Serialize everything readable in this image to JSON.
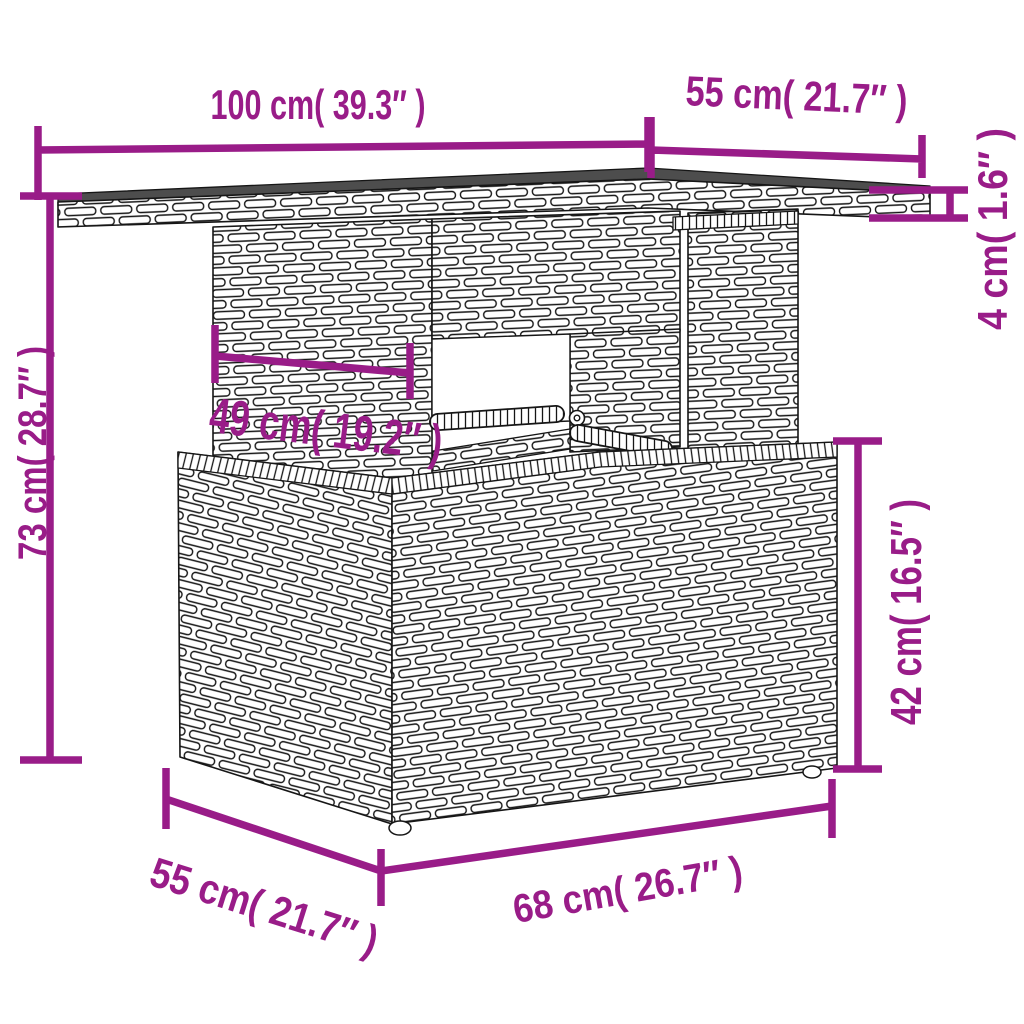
{
  "diagram": {
    "type": "product-dimension-diagram",
    "subject": "poly rattan garden table with storage base",
    "style": {
      "dimension_color": "#991C88",
      "outline_color": "#161616",
      "tabletop_color": "#4d4d4d",
      "wicker_fill": "#ffffff",
      "background_color": "#ffffff"
    },
    "dimensions": {
      "top_width": {
        "value_cm": 100,
        "value_in": 39.3,
        "label": "100 cm( 39.3″ )"
      },
      "top_depth": {
        "value_cm": 55,
        "value_in": 21.7,
        "label": "55 cm( 21.7″ )"
      },
      "top_thickness": {
        "value_cm": 4,
        "value_in": 1.6,
        "label": "4 cm( 1.6″ )"
      },
      "total_height": {
        "value_cm": 73,
        "value_in": 28.7,
        "label": "73 cm( 28.7″ )"
      },
      "pedestal_width": {
        "value_cm": 49,
        "value_in": 19.2,
        "label": "49 cm( 19.2″ )"
      },
      "base_height": {
        "value_cm": 42,
        "value_in": 16.5,
        "label": "42 cm( 16.5″ )"
      },
      "base_width": {
        "value_cm": 68,
        "value_in": 26.7,
        "label": "68 cm( 26.7″ )"
      },
      "base_depth": {
        "value_cm": 55,
        "value_in": 21.7,
        "label": "55 cm( 21.7″ )"
      }
    }
  }
}
